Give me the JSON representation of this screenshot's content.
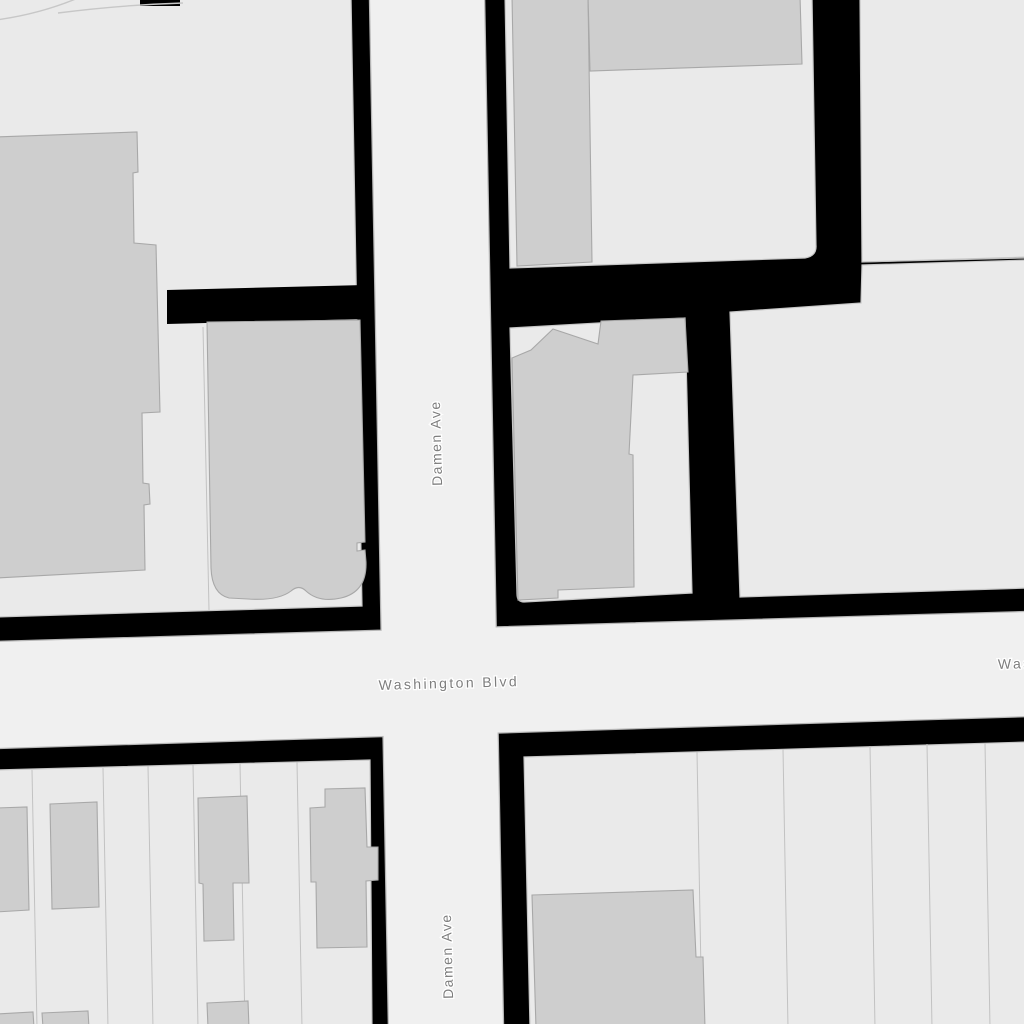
{
  "map": {
    "street_labels": {
      "damen_top": "Damen Ave",
      "damen_bottom": "Damen Ave",
      "washington": "Washington Blvd",
      "washington_right_partial": "Washington Blvd"
    }
  },
  "theme": {
    "bg": "#000000",
    "road_fill": "#f0f0f0",
    "road_casing": "#b6b6b6",
    "block_fill": "#eaeaea",
    "block_stroke": "#c7c7c7",
    "building_fill": "#cecece",
    "building_stroke": "#a8a8a8",
    "parcel_line": "#c2c2c2",
    "label_color": "#7d7d7d",
    "label_halo": "#ffffff"
  }
}
